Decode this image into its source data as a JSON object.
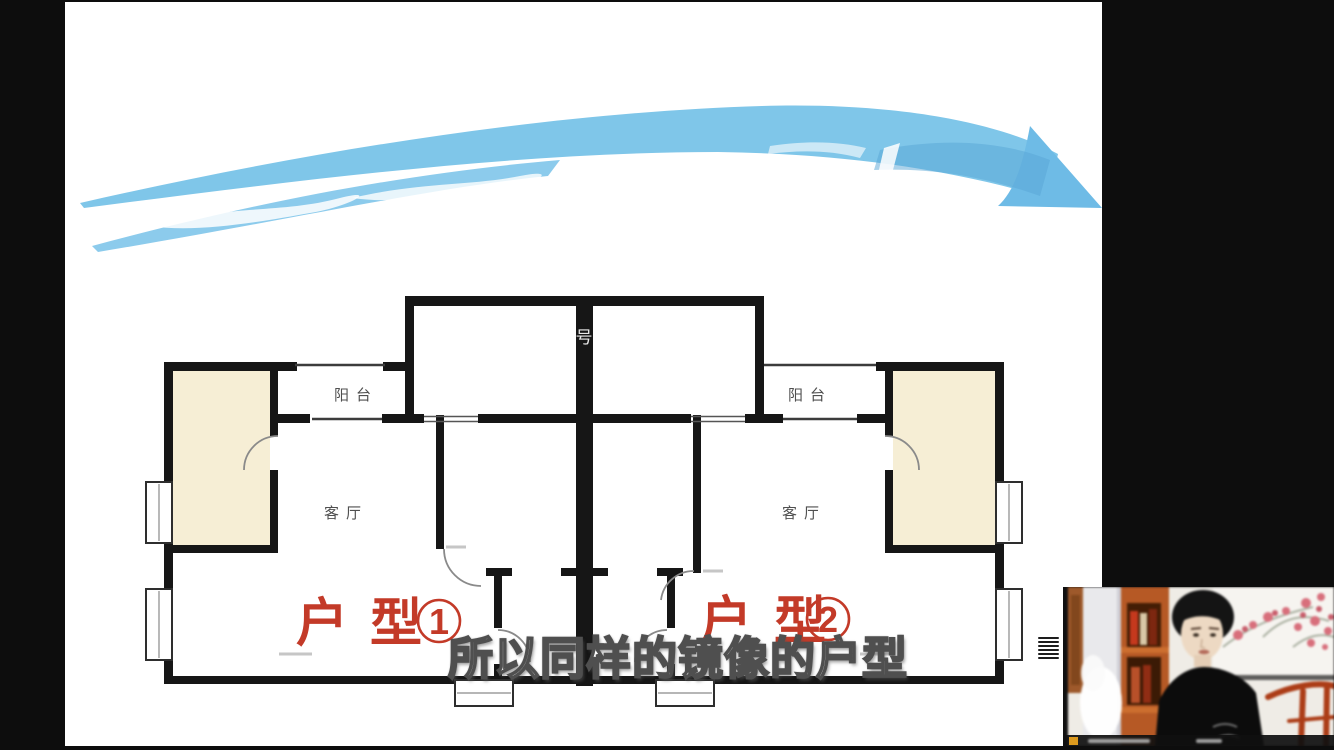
{
  "frame": {
    "background_color": "#0d0d0d",
    "slide_background": "#ffffff"
  },
  "arrow": {
    "description": "hand-drawn curved arrow sweeping left to right",
    "color": "#7fc6e9",
    "highlight_color": "#ffffff",
    "shade_color": "#58a6d6"
  },
  "floorplan": {
    "wall_color": "#161616",
    "accent_room_fill": "#f6eed5",
    "label_color": "#c33a28",
    "room_label_color": "#4f4f4f",
    "watermark_glyph": "号",
    "units": [
      {
        "title": "户型",
        "circled_number": "1",
        "balcony_label": "阳台",
        "living_room_label": "客厅"
      },
      {
        "title": "户型",
        "circled_number": "2",
        "balcony_label": "阳台",
        "living_room_label": "客厅"
      }
    ]
  },
  "subtitle": {
    "text": "所以同样的镜像的户型",
    "color": "#ffffff",
    "outline_color": "#4f4f4f"
  },
  "webcam": {
    "caption_icon_color": "#dd9a1e",
    "shelf_color": "#b25a28",
    "chair_color": "#a83e1a"
  }
}
